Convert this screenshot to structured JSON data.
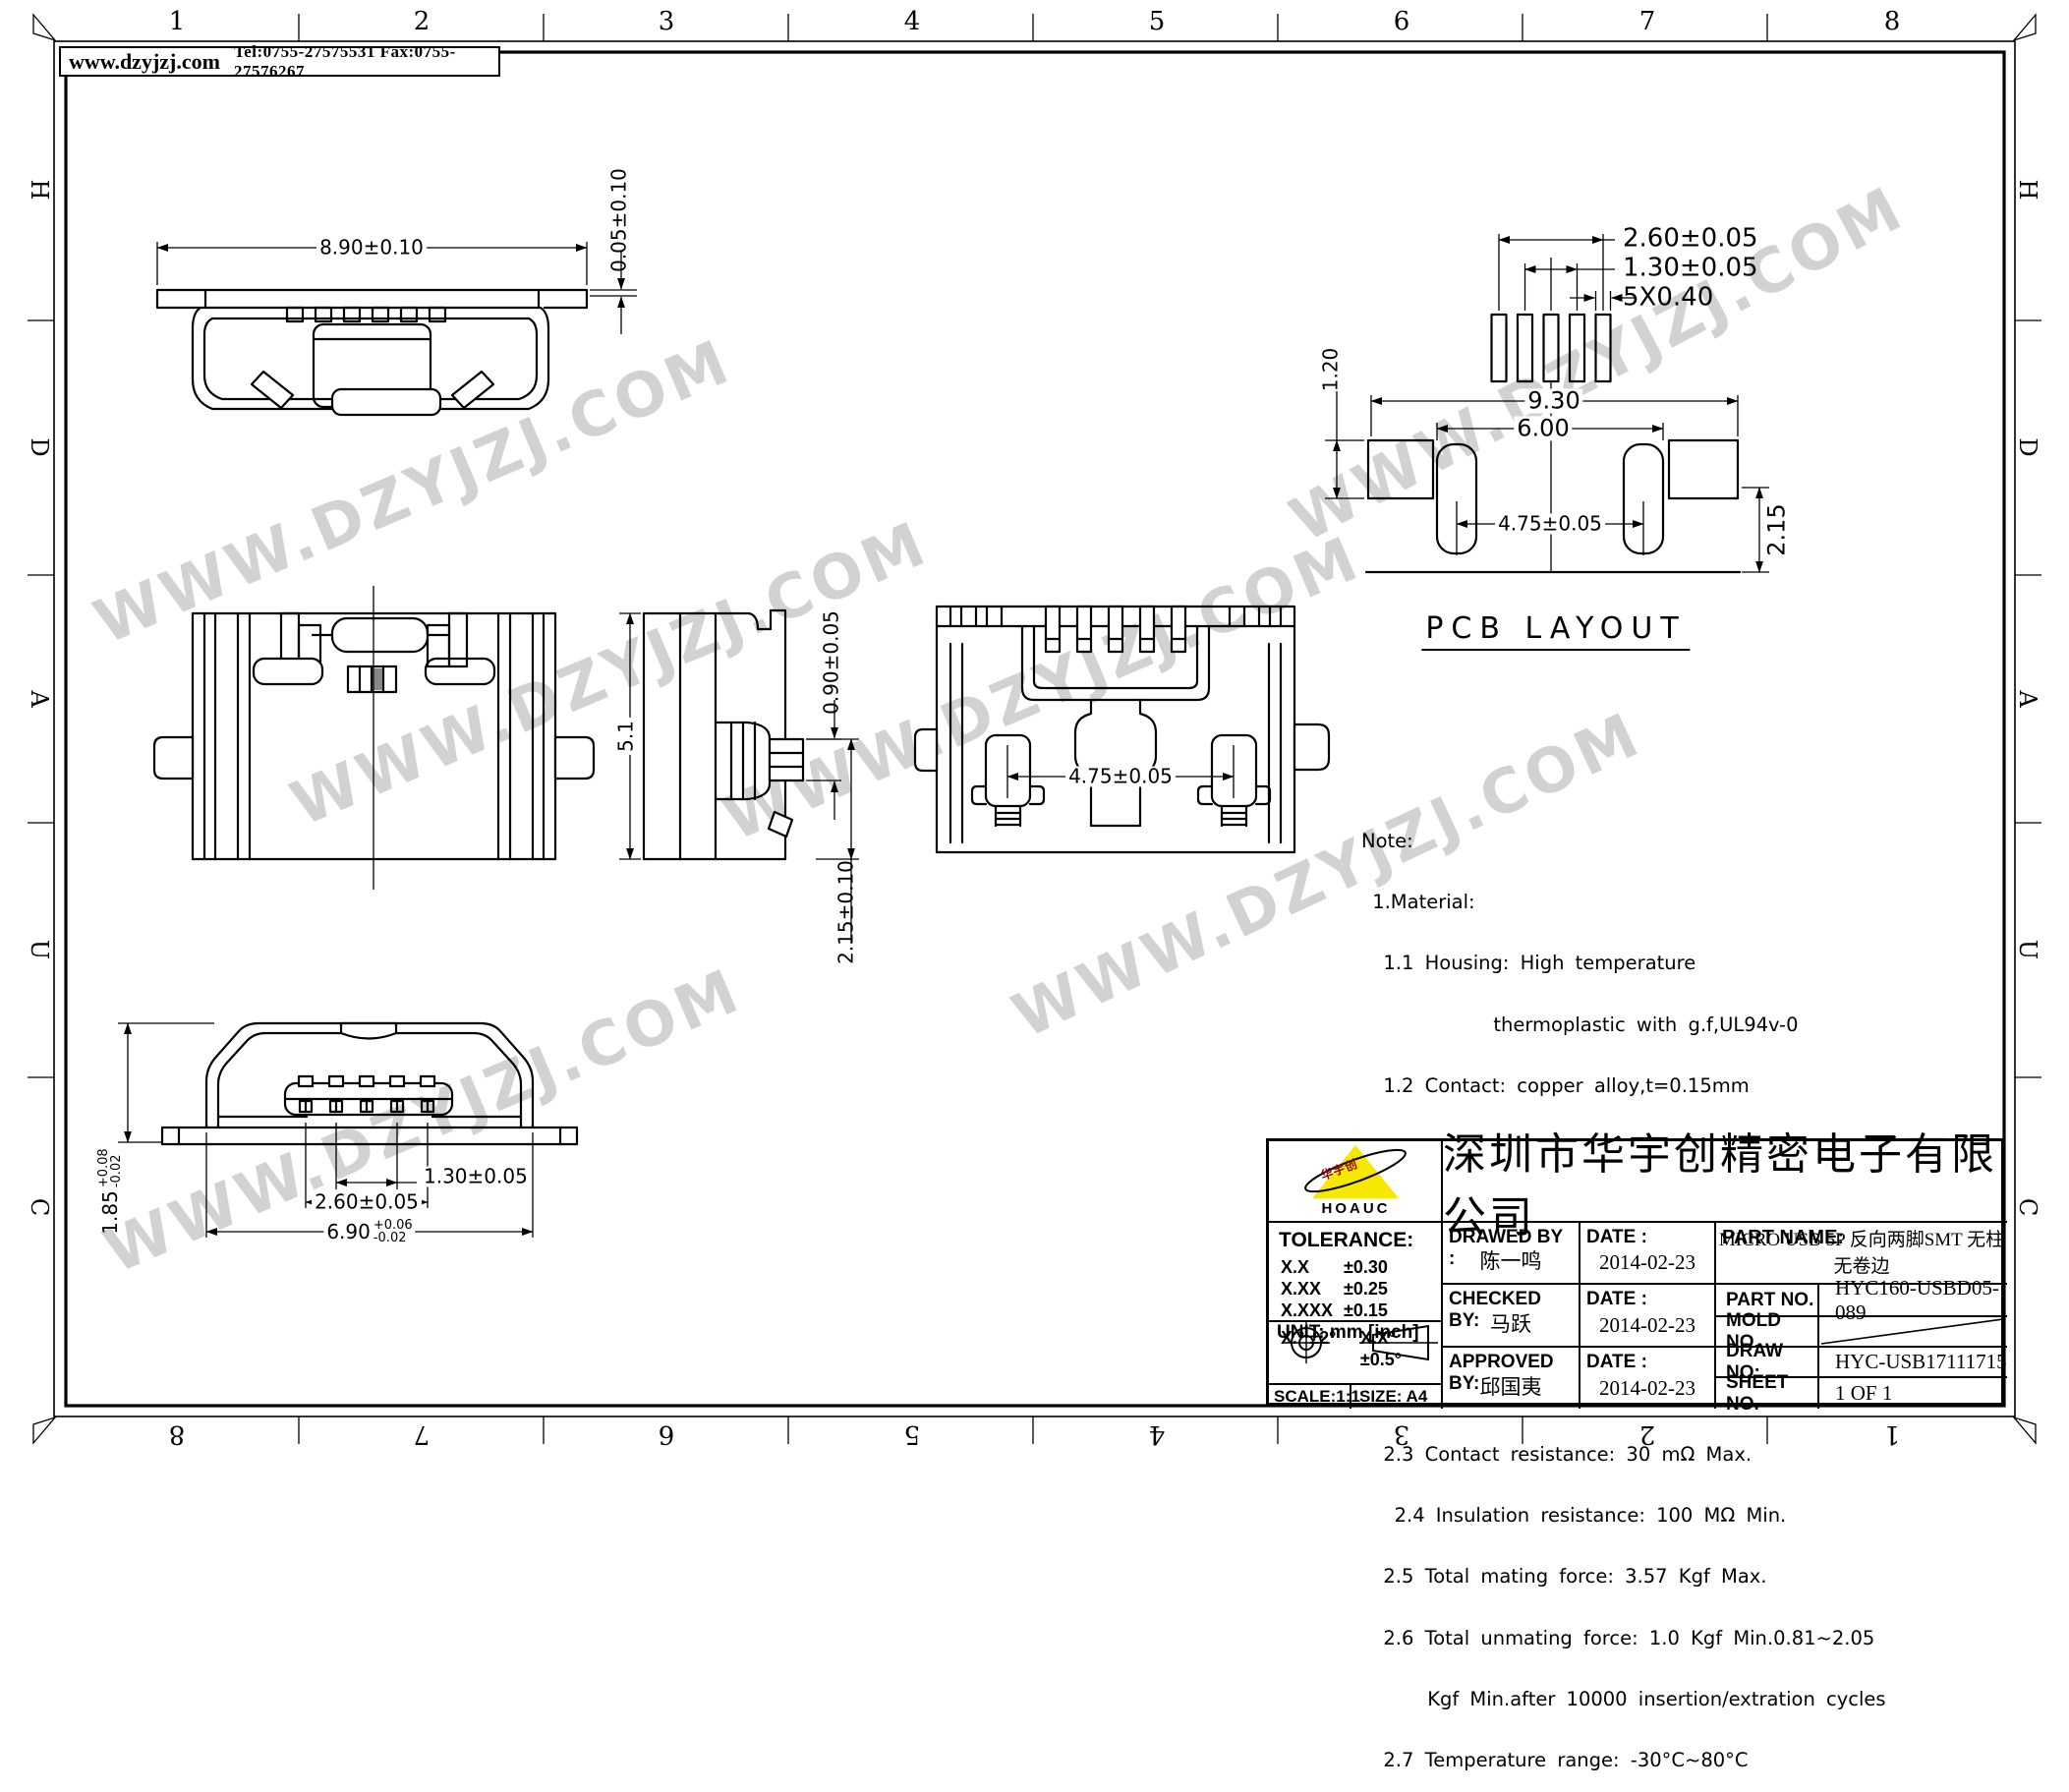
{
  "header": {
    "website": "www.dzyjzj.com",
    "contact": "Tel:0755-27575531  Fax:0755-27576267"
  },
  "border": {
    "cols": [
      "1",
      "2",
      "3",
      "4",
      "5",
      "6",
      "7",
      "8"
    ],
    "rows": [
      "H",
      "D",
      "A",
      "U",
      "C"
    ]
  },
  "watermark": "WWW.DZYJZJ.COM",
  "pcb_title": "PCB LAYOUT",
  "dims": {
    "front_width": "8.90±0.10",
    "front_offset": "0.05±0.10",
    "side_height": "5.1",
    "side_pin": "0.90±0.05",
    "side_bottom": "2.15±0.10",
    "bottom_feet": "4.75±0.05",
    "face_height": "1.85",
    "face_height_plus": "+0.08",
    "face_height_minus": "-0.02",
    "face_pitch": "1.30±0.05",
    "face_span": "2.60±0.05",
    "face_width": "6.90",
    "face_width_plus": "+0.06",
    "face_width_minus": "-0.02",
    "pcb_span": "2.60±0.05",
    "pcb_pitch": "1.30±0.05",
    "pcb_pad": "5X0.40",
    "pcb_outer": "9.30",
    "pcb_inner": "6.00",
    "pcb_pad_h": "1.20",
    "pcb_feet": "4.75±0.05",
    "pcb_edge": "2.15"
  },
  "notes": {
    "lines": [
      "Note:",
      " 1.Material:",
      "  1.1 Housing: High temperature",
      "            thermoplastic with g.f,UL94v-0",
      "  1.2 Contact: copper alloy,t=0.15mm",
      "  1.3 Shell: copper alloy&SUS",
      " 2.Specification:",
      "  2.1 Current rating: 1 A Max.",
      "  2.2 Dielectric withstanding",
      "            voltage: 100 V(ac) for 1 min.",
      "  2.3 Contact resistance: 30 mΩ Max.",
      "   2.4 Insulation resistance: 100 MΩ Min.",
      "  2.5 Total mating force: 3.57 Kgf Max.",
      "  2.6 Total unmating force: 1.0 Kgf Min.0.81~2.05",
      "      Kgf Min.after 10000 insertion/extration cycles",
      "  2.7 Temperature range: -30°C~80°C"
    ]
  },
  "title_block": {
    "company": "深圳市华宇创精密电子有限公司",
    "logo_text": "HOAUC",
    "logo_mark": "华宇创",
    "tolerance_label": "TOLERANCE:",
    "tol_rows": [
      {
        "k": "X.X",
        "v": "±0.30"
      },
      {
        "k": "X.XX",
        "v": "±0.25"
      },
      {
        "k": "X.XXX",
        "v": "±0.15"
      }
    ],
    "tol_angle1": "X.°  ±2°",
    "tol_angle2": "X.X°  ±0.5°",
    "unit_label": "UNIT:  mm  [inch]",
    "scale_label": "SCALE:1:1",
    "size_label": "SIZE:  A4",
    "drawed_label": "DRAWED BY :",
    "drawed_name": "陈一鸣",
    "drawed_date": "2014-02-23",
    "checked_label": "CHECKED BY:",
    "checked_name": "马跃",
    "checked_date": "2014-02-23",
    "approved_label": "APPROVED BY:",
    "approved_name": "邱国夷",
    "approved_date": "2014-02-23",
    "date_label": "DATE :",
    "part_name_label": "PART NAME:",
    "part_name": "MICRO USB 5P 反向两脚SMT 无柱无卷边",
    "part_no_label": "PART NO.",
    "part_no": "HYC160-USBD05-089",
    "mold_no_label": "MOLD NO.",
    "draw_no_label": "DRAW NO:",
    "draw_no": "HYC-USB17111715",
    "sheet_no_label": "SHEET NO.",
    "sheet_no": "1 OF 1"
  }
}
